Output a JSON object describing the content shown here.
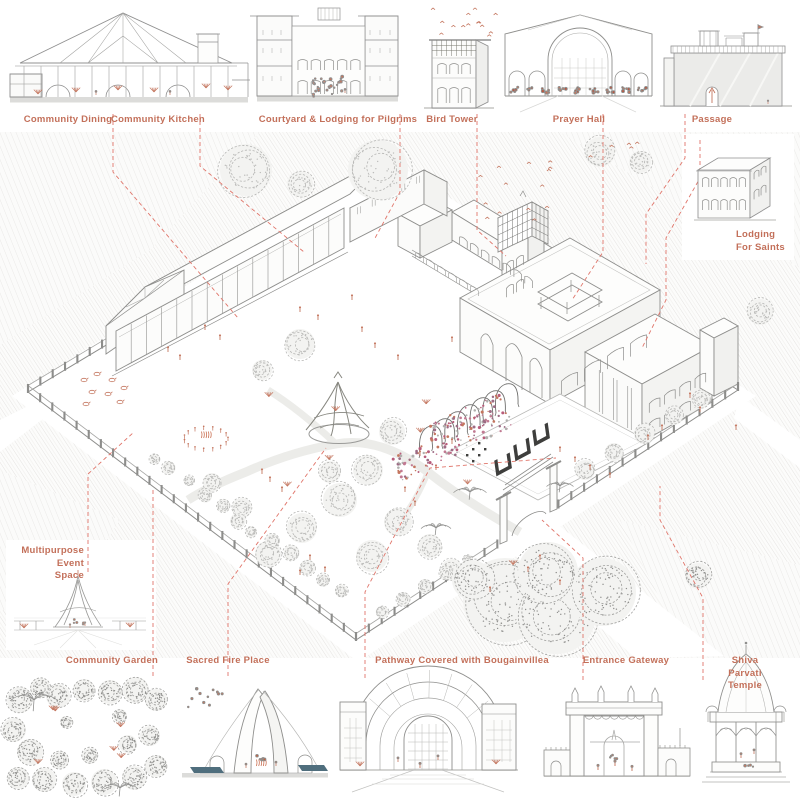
{
  "palette": {
    "label_text": "#c3705a",
    "leader_dash": "#e0756a",
    "line_gray": "#8e8e8c",
    "figure_salmon": "#c4765f",
    "bougainvillea_pink": "#b85d7b",
    "water_teal": "#4f6e7d",
    "glyph_dark": "#3e3e3c"
  },
  "labels": {
    "community_dining": "Community Dining",
    "community_kitchen": "Community Kitchen",
    "courtyard_lodging": "Courtyard & Lodging for Pilgrims",
    "bird_tower": "Bird Tower",
    "prayer_hall": "Prayer Hall",
    "passage": "Passage",
    "lodging_for_saints": "Lodging\nFor Saints",
    "multipurpose_event_space": "Multipurpose Event\nSpace",
    "community_garden": "Community Garden",
    "sacred_fire_place": "Sacred Fire Place",
    "pathway_bougainvillea": "Pathway Covered with Bougainvillea",
    "entrance_gateway": "Entrance Gateway",
    "shiva_parvati_temple": "Shiva Parvati Temple"
  }
}
